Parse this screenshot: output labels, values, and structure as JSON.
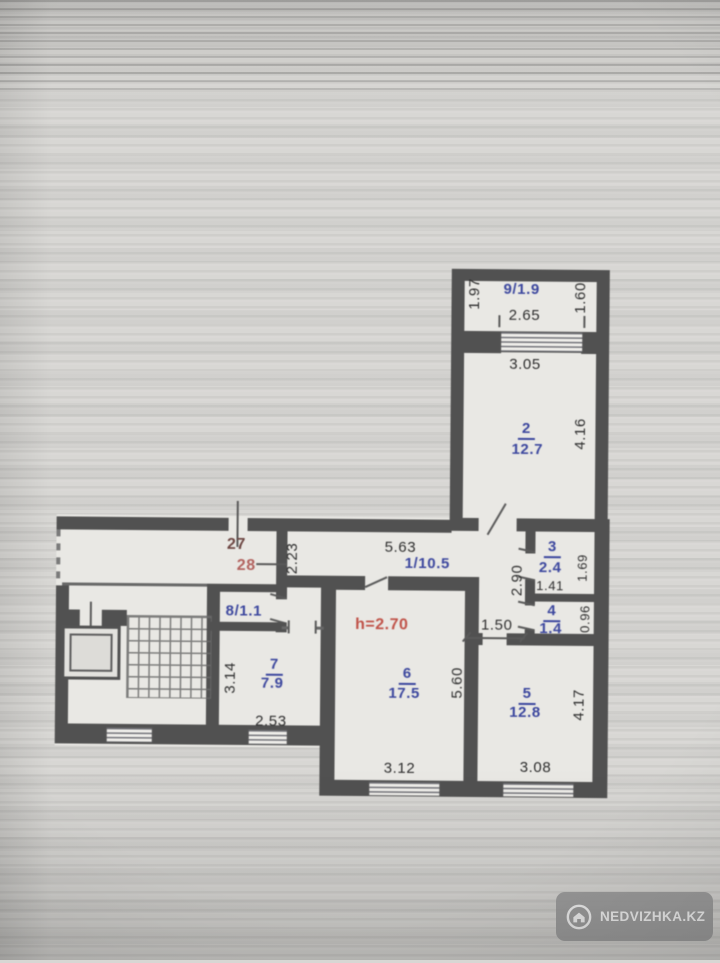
{
  "plan": {
    "rooms": {
      "balcony": {
        "label": "9/1.9"
      },
      "hallway": {
        "label": "1/10.5"
      },
      "closet": {
        "label": "8/1.1"
      },
      "r2": {
        "number": "2",
        "area": "12.7"
      },
      "r3": {
        "number": "3",
        "area": "2.4"
      },
      "r4": {
        "number": "4",
        "area": "1.4"
      },
      "r5": {
        "number": "5",
        "area": "12.8"
      },
      "r6": {
        "number": "6",
        "area": "17.5"
      },
      "r7": {
        "number": "7",
        "area": "7.9"
      }
    },
    "annotations": {
      "apt_number_top": "27",
      "apt_number_bottom": "28",
      "ceiling_height": "h=2.70"
    },
    "dims": {
      "d197": "1.97",
      "d265": "2.65",
      "d160": "1.60",
      "d305": "3.05",
      "d416": "4.16",
      "d563": "5.63",
      "d223": "2.23",
      "d290": "2.90",
      "d169": "1.69",
      "d141": "1.41",
      "d150": "1.50",
      "d096": "0.96",
      "d314": "3.14",
      "d253": "2.53",
      "d560": "5.60",
      "d312": "3.12",
      "d308": "3.08",
      "d417": "4.17"
    },
    "colors": {
      "wall": "#515151",
      "room_label_blue": "#3c479e",
      "annotation_red": "#c05248",
      "paper": "#e9e8e4"
    }
  },
  "watermark": {
    "text": "NEDVIZHKA.KZ",
    "icon": "house-icon"
  }
}
